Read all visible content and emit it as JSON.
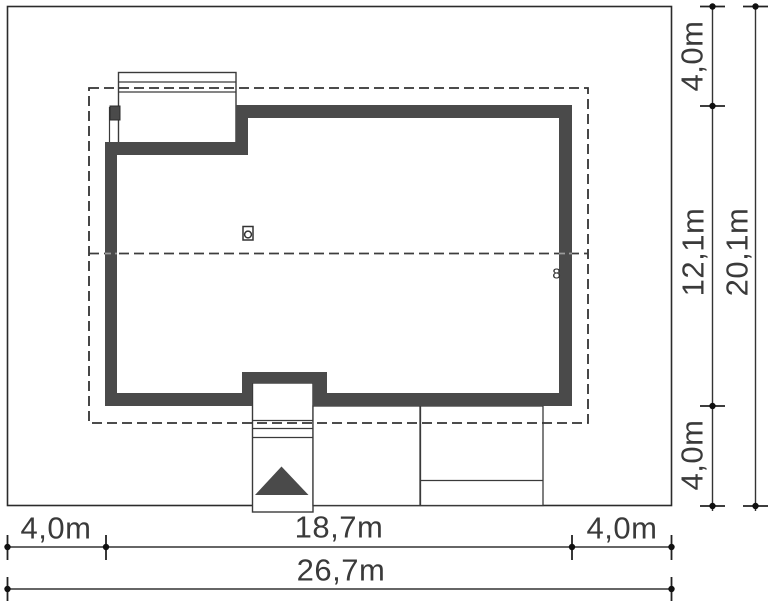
{
  "plan": {
    "wall_marker": "8",
    "icons": {
      "chimney": "chimney-vent-icon",
      "entrance": "entrance-arrow-icon"
    },
    "colors": {
      "background": "#ffffff",
      "wall": "#4a4a4a",
      "line": "#333333",
      "dashed_line": "#333333",
      "text": "#3a3a3a"
    }
  },
  "dimensions": {
    "right": {
      "inner": [
        "4,0m",
        "12,1m",
        "4,0m"
      ],
      "total": "20,1m"
    },
    "bottom": {
      "inner": [
        "4,0m",
        "18,7m",
        "4,0m"
      ],
      "total": "26,7m"
    }
  }
}
